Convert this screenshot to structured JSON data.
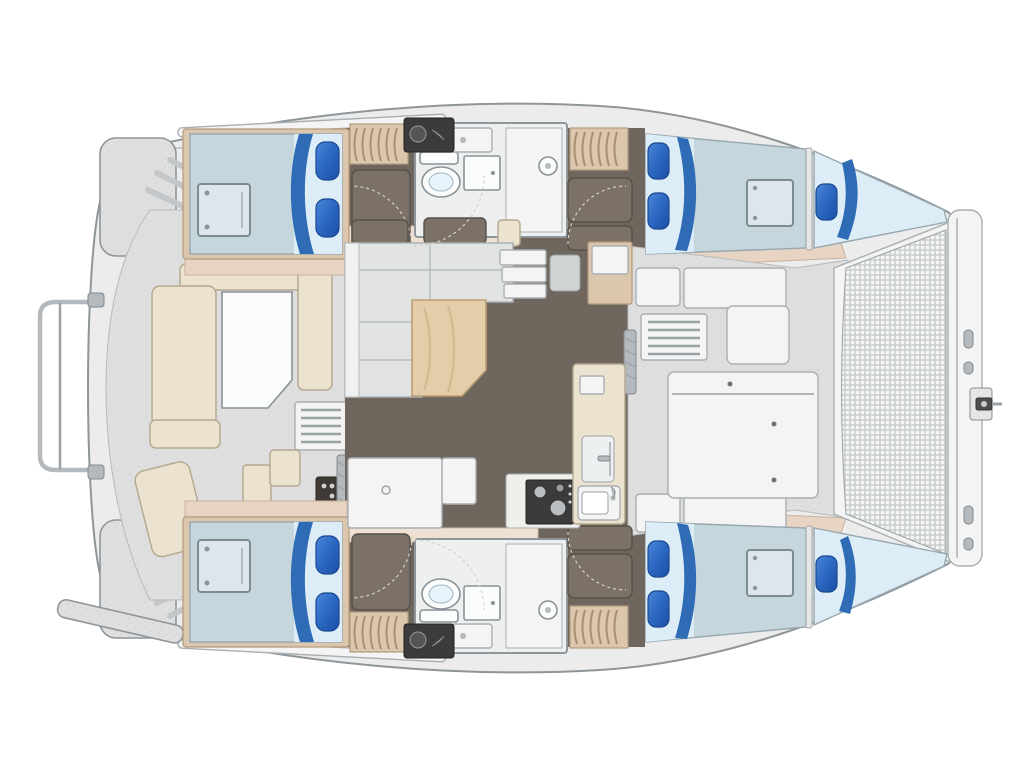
{
  "diagram": {
    "type": "boat-floor-plan",
    "subject": "Catamaran yacht accommodation layout, top view, bow pointing right",
    "visible_text": [],
    "colors": {
      "canvas": "#ffffff",
      "hull-fill": "#ebeceb",
      "hull-stroke": "#8e969b",
      "cabin-floor": "#6f665d",
      "door-panel": "#7c7166",
      "bulkhead-tan": "#e8d4c3",
      "bulkhead-tan-light": "#eee0d2",
      "wood-light": "#dcc7ae",
      "mattress": "#c6d6dd",
      "sheet": "#dcedf7",
      "blanket-blue": "#2f6cb5",
      "pillow-blue": "#2b67c0",
      "pillow-blue-dark": "#1a4c9f",
      "cream": "#ebe3d0",
      "white-furniture": "#f3f4f3",
      "table-wood": "#e4cda9",
      "sofa-gray": "#e2e4e3",
      "stove-black": "#3b3b3b",
      "chrome": "#b3b9bd",
      "fixture-white": "#fbfcfc",
      "mesh-line": "#c6c9ca"
    },
    "features": {
      "cabins": [
        {
          "id": "port-aft-cabin",
          "position": "top-left",
          "bed": "double",
          "pillows": 2,
          "locker": true
        },
        {
          "id": "port-forward-cabin",
          "position": "top-right",
          "bed": "double-tapered",
          "pillows": 3,
          "locker": true
        },
        {
          "id": "starboard-aft-cabin",
          "position": "bottom-left",
          "bed": "double",
          "pillows": 2,
          "locker": true
        },
        {
          "id": "starboard-forward-cabin",
          "position": "bottom-right",
          "bed": "double-tapered",
          "pillows": 3,
          "locker": true
        }
      ],
      "bathrooms": [
        {
          "id": "port-head",
          "position": "top-center",
          "fixtures": [
            "toilet",
            "sink",
            "vanity",
            "shower"
          ]
        },
        {
          "id": "starboard-head",
          "position": "bottom-center",
          "fixtures": [
            "toilet",
            "sink",
            "vanity",
            "shower"
          ]
        }
      ],
      "salon": {
        "sofa": "L-shaped",
        "table": "wood",
        "nav_station": true,
        "entry_steps": 3
      },
      "galley": {
        "stove": true,
        "sink": true,
        "refrigerator": true,
        "counters": 2
      },
      "aft_cockpit": {
        "bench": "U-shaped",
        "table": true,
        "deck_grate": true,
        "wet_bar": true
      },
      "forward_cockpit": {
        "benches": 4,
        "storage_locker": true,
        "vent_grate": true,
        "table": true
      },
      "trampoline": {
        "position": "bow",
        "mesh": true
      },
      "bow_crossbeam": {
        "anchor_roller": true
      },
      "stern": {
        "swim_rail": true,
        "transom_steps": 2,
        "platforms": 2
      }
    }
  }
}
